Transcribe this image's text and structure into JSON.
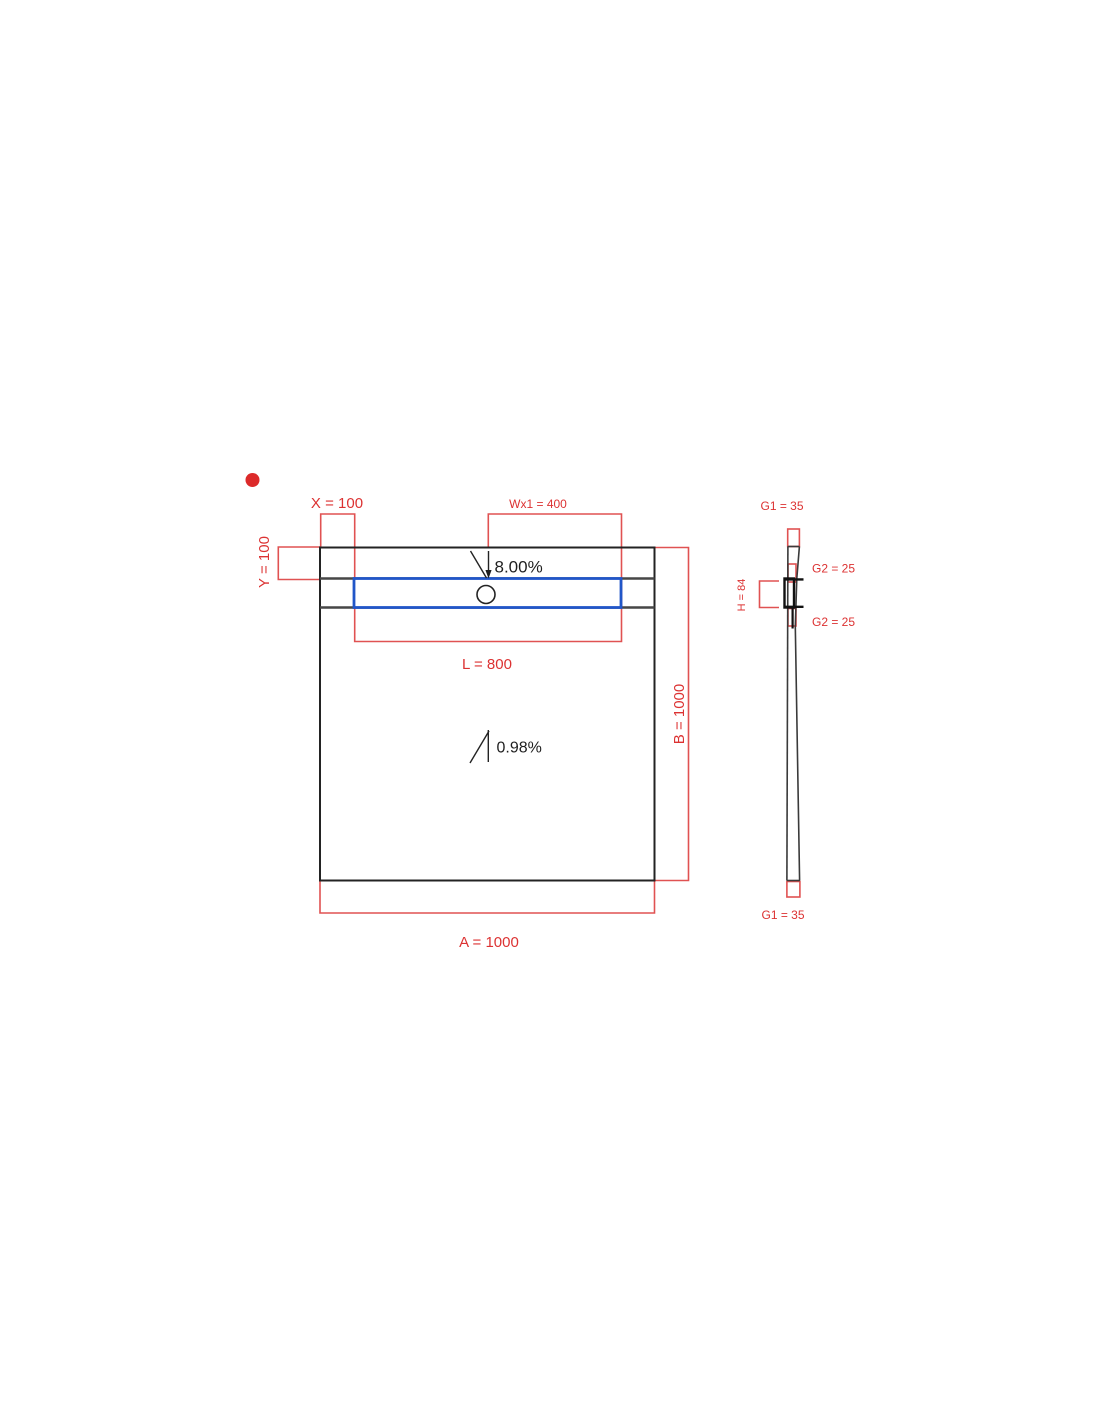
{
  "colors": {
    "dimension_red": "#e05252",
    "label_red": "#dc3232",
    "marker_red": "#dc2a2a",
    "outline_dark": "#232323",
    "strip_gray": "#474747",
    "profile_gray": "#3a3a3a",
    "channel_blue": "#2156c8",
    "section_black": "#111111"
  },
  "plan_view": {
    "dim_x_label": "X = 100",
    "dim_wx1_label": "Wx1 = 400",
    "dim_y_label": "Y = 100",
    "top_slope_label": "8.00%",
    "dim_l_label": "L = 800",
    "dim_b_label": "B = 1000",
    "main_slope_label": "0.98%",
    "dim_a_label": "A = 1000"
  },
  "section_view": {
    "g1_top_label": "G1 = 35",
    "g2_upper_label": "G2 = 25",
    "h_label": "H = 84",
    "g2_lower_label": "G2 = 25",
    "g1_bottom_label": "G1 = 35"
  }
}
